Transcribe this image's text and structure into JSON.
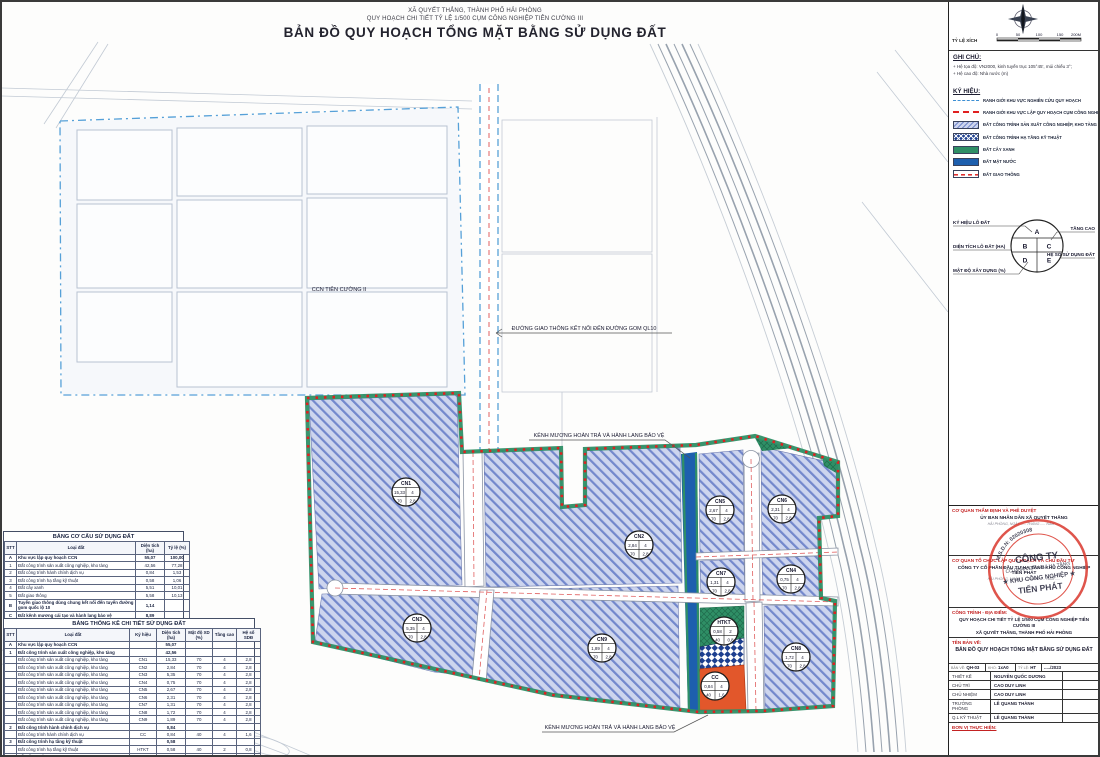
{
  "header": {
    "line1": "XÃ QUYẾT THẮNG, THÀNH PHỐ HẢI PHÒNG",
    "line2": "QUY HOẠCH CHI TIẾT TỶ LỆ 1/500 CỤM CÔNG NGHIỆP TIÊN CƯỜNG III",
    "title": "BẢN ĐỒ QUY HOẠCH TỔNG MẶT BẰNG SỬ DỤNG ĐẤT"
  },
  "scalebar": {
    "label": "TỶ LỆ XÍCH",
    "ticks": [
      "0",
      "50",
      "100",
      "150",
      "200M"
    ]
  },
  "notes": {
    "title": "GHI CHÚ:",
    "items": [
      "Hệ tọa độ: VN2000, kinh tuyến trục 105°45', múi chiếu 3°;",
      "Hệ cao độ: Nhà nước (m)"
    ]
  },
  "legend": {
    "title": "KÝ HIỆU:",
    "items": [
      {
        "key": "study",
        "label": "RANH GIỚI KHU VỰC NGHIÊN CỨU QUY HOẠCH"
      },
      {
        "key": "plan",
        "label": "RANH GIỚI KHU VỰC LẬP QUY HOẠCH CỤM CÔNG NGHIỆP"
      },
      {
        "key": "industrial",
        "label": "ĐẤT CÔNG TRÌNH SẢN XUẤT CÔNG NGHIỆP, KHO TÀNG"
      },
      {
        "key": "technical",
        "label": "ĐẤT CÔNG TRÌNH HẠ TẦNG KỸ THUẬT"
      },
      {
        "key": "green",
        "label": "ĐẤT CÂY XANH"
      },
      {
        "key": "water",
        "label": "ĐẤT MẶT NƯỚC"
      },
      {
        "key": "traffic",
        "label": "ĐẤT GIAO THÔNG"
      }
    ]
  },
  "parcel_key": {
    "key_label": "KÝ HIỆU LÔ ĐẤT",
    "area_label": "DIỆN TÍCH LÔ ĐẤT (HA)",
    "density_label": "MẬT ĐỘ XÂY DỰNG (%)",
    "floors_label": "TẦNG CAO",
    "far_label": "HỆ SỐ SỬ DỤNG ĐẤT",
    "cells": [
      "A",
      "B",
      "C",
      "D",
      "E"
    ]
  },
  "map": {
    "annotations": {
      "ccn2": "CCN TIÊN CƯỜNG II",
      "connect_road": "ĐƯỜNG GIAO THÔNG KẾT NỐI ĐẾN ĐƯỜNG GOM QL10",
      "channel_top": "KÊNH MƯƠNG HOÀN TRẢ VÀ HÀNH LANG BẢO VỆ",
      "channel_bottom": "KÊNH MƯƠNG HOÀN TRẢ VÀ HÀNH LANG BẢO VỆ"
    },
    "parcels": [
      {
        "id": "CN1",
        "area": "15,33",
        "floors": "4",
        "density": "70",
        "far": "2,8",
        "x": 404,
        "y": 490
      },
      {
        "id": "CN2",
        "area": "2,84",
        "floors": "4",
        "density": "70",
        "far": "2,8",
        "x": 637,
        "y": 543
      },
      {
        "id": "CN5",
        "area": "2,67",
        "floors": "4",
        "density": "70",
        "far": "2,8",
        "x": 718,
        "y": 508
      },
      {
        "id": "CN6",
        "area": "2,31",
        "floors": "4",
        "density": "70",
        "far": "2,8",
        "x": 780,
        "y": 507
      },
      {
        "id": "CN7",
        "area": "1,31",
        "floors": "4",
        "density": "70",
        "far": "2,8",
        "x": 719,
        "y": 580
      },
      {
        "id": "CN4",
        "area": "0,75",
        "floors": "4",
        "density": "70",
        "far": "2,8",
        "x": 789,
        "y": 577
      },
      {
        "id": "CN3",
        "area": "5,35",
        "floors": "4",
        "density": "70",
        "far": "2,8",
        "x": 415,
        "y": 626
      },
      {
        "id": "CN9",
        "area": "1,89",
        "floors": "4",
        "density": "70",
        "far": "2,8",
        "x": 600,
        "y": 646
      },
      {
        "id": "HTKT",
        "area": "0,58",
        "floors": "2",
        "density": "40",
        "far": "0,8",
        "x": 722,
        "y": 629
      },
      {
        "id": "CC",
        "area": "0,84",
        "floors": "4",
        "density": "40",
        "far": "1,6",
        "x": 713,
        "y": 684
      },
      {
        "id": "CN8",
        "area": "1,72",
        "floors": "4",
        "density": "70",
        "far": "2,8",
        "x": 794,
        "y": 655
      }
    ]
  },
  "tables": {
    "structure": {
      "title": "BẢNG CƠ CẤU SỬ DỤNG ĐẤT",
      "columns": [
        "STT",
        "Loại đất",
        "Diện tích (ha)",
        "Tỷ lệ (%)"
      ],
      "rows": [
        {
          "b": true,
          "c": [
            "A",
            "Khu vực lập quy hoạch CCN",
            "55,07",
            "100,00"
          ]
        },
        {
          "b": false,
          "c": [
            "1",
            "Đất công trình sản xuất công nghiệp, kho tàng",
            "42,56",
            "77,28"
          ]
        },
        {
          "b": false,
          "c": [
            "2",
            "Đất công trình hành chính dịch vụ",
            "0,84",
            "1,53"
          ]
        },
        {
          "b": false,
          "c": [
            "3",
            "Đất công trình hạ tầng kỹ thuật",
            "0,58",
            "1,06"
          ]
        },
        {
          "b": false,
          "c": [
            "4",
            "Đất cây xanh",
            "5,51",
            "10,01"
          ]
        },
        {
          "b": false,
          "c": [
            "5",
            "Đất giao thông",
            "5,58",
            "10,13"
          ]
        },
        {
          "b": true,
          "c": [
            "B",
            "Tuyến giao thông dùng chung kết nối đến tuyến đường gom quốc lộ 10",
            "1,14",
            ""
          ]
        },
        {
          "b": true,
          "c": [
            "C",
            "Đất kênh mương cải tạo và hành lang bảo vệ",
            "8,89",
            ""
          ]
        }
      ]
    },
    "detail": {
      "title": "BẢNG THỐNG KÊ CHI TIẾT SỬ DỤNG ĐẤT",
      "columns": [
        "STT",
        "Loại đất",
        "Ký hiệu",
        "Diện tích (ha)",
        "Mật độ XD (%)",
        "Tầng cao",
        "Hệ số SDĐ"
      ],
      "rows": [
        {
          "b": true,
          "c": [
            "A",
            "Khu vực lập quy hoạch CCN",
            "",
            "55,07",
            "",
            "",
            ""
          ]
        },
        {
          "b": true,
          "c": [
            "1",
            "Đất công trình sản xuất công nghiệp, kho tàng",
            "",
            "42,56",
            "",
            "",
            ""
          ]
        },
        {
          "b": false,
          "c": [
            "",
            "Đất công trình sản xuất công nghiệp, kho tàng",
            "CN1",
            "15,33",
            "70",
            "4",
            "2,8"
          ]
        },
        {
          "b": false,
          "c": [
            "",
            "Đất công trình sản xuất công nghiệp, kho tàng",
            "CN2",
            "2,84",
            "70",
            "4",
            "2,8"
          ]
        },
        {
          "b": false,
          "c": [
            "",
            "Đất công trình sản xuất công nghiệp, kho tàng",
            "CN3",
            "5,35",
            "70",
            "4",
            "2,8"
          ]
        },
        {
          "b": false,
          "c": [
            "",
            "Đất công trình sản xuất công nghiệp, kho tàng",
            "CN4",
            "0,75",
            "70",
            "4",
            "2,8"
          ]
        },
        {
          "b": false,
          "c": [
            "",
            "Đất công trình sản xuất công nghiệp, kho tàng",
            "CN5",
            "2,67",
            "70",
            "4",
            "2,8"
          ]
        },
        {
          "b": false,
          "c": [
            "",
            "Đất công trình sản xuất công nghiệp, kho tàng",
            "CN6",
            "2,31",
            "70",
            "4",
            "2,8"
          ]
        },
        {
          "b": false,
          "c": [
            "",
            "Đất công trình sản xuất công nghiệp, kho tàng",
            "CN7",
            "1,31",
            "70",
            "4",
            "2,8"
          ]
        },
        {
          "b": false,
          "c": [
            "",
            "Đất công trình sản xuất công nghiệp, kho tàng",
            "CN8",
            "1,72",
            "70",
            "4",
            "2,8"
          ]
        },
        {
          "b": false,
          "c": [
            "",
            "Đất công trình sản xuất công nghiệp, kho tàng",
            "CN9",
            "1,89",
            "70",
            "4",
            "2,8"
          ]
        },
        {
          "b": true,
          "c": [
            "2",
            "Đất công trình hành chính dịch vụ",
            "",
            "0,84",
            "",
            "",
            ""
          ]
        },
        {
          "b": false,
          "c": [
            "",
            "Đất công trình hành chính dịch vụ",
            "CC",
            "0,84",
            "40",
            "4",
            "1,6"
          ]
        },
        {
          "b": true,
          "c": [
            "3",
            "Đất công trình hạ tầng kỹ thuật",
            "",
            "0,58",
            "",
            "",
            ""
          ]
        },
        {
          "b": false,
          "c": [
            "",
            "Đất công trình hạ tầng kỹ thuật",
            "HTKT",
            "0,58",
            "40",
            "2",
            "0,8"
          ]
        },
        {
          "b": true,
          "c": [
            "4",
            "Đất cây xanh",
            "",
            "5,51",
            "",
            "",
            ""
          ]
        },
        {
          "b": false,
          "c": [
            "",
            "Đất cây xanh",
            "CX",
            "5,51",
            "5",
            "2",
            "0,1"
          ]
        },
        {
          "b": true,
          "c": [
            "5",
            "Đất giao thông",
            "",
            "5,58",
            "",
            "",
            ""
          ]
        },
        {
          "b": false,
          "c": [
            "",
            "Đất giao thông",
            "",
            "5,58",
            "-",
            "-",
            "-"
          ]
        }
      ]
    }
  },
  "titleblock": {
    "approve": {
      "label": "CƠ QUAN THẨM ĐỊNH VÀ PHÊ DUYỆT",
      "name": "ỦY BAN NHÂN DÂN XÃ QUYẾT THẮNG"
    },
    "org": {
      "label": "CƠ QUAN TỔ CHỨC LẬP QUY HOẠCH VÀ CHỦ ĐẦU TƯ",
      "name": "CÔNG TY CỔ PHẦN ĐẦU TƯ HẠ TẦNG KHU CÔNG NGHIỆP TIẾN PHÁT"
    },
    "date_line": "HẢI PHÒNG, NGÀY ..... THÁNG ..... NĂM .....",
    "project": {
      "label": "CÔNG TRÌNH - ĐỊA ĐIỂM:",
      "line1": "QUY HOẠCH CHI TIẾT TỶ LỆ 1/500 CỤM CÔNG NGHIỆP TIÊN CƯỜNG III",
      "line2": "XÃ QUYẾT THẮNG, THÀNH PHỐ HẢI PHÒNG"
    },
    "drawing": {
      "label": "TÊN BẢN VẼ:",
      "name": "BẢN ĐỒ QUY HOẠCH TỔNG MẶT BẰNG SỬ DỤNG ĐẤT"
    },
    "meta": [
      {
        "l": "BẢN VẼ:",
        "v": "QH-03"
      },
      {
        "l": "KHỔ:",
        "v": "1xA0"
      },
      {
        "l": "TỶ LỆ:",
        "v": "HT"
      },
      {
        "l": "",
        "v": "...../2023"
      }
    ],
    "personnel": [
      {
        "role": "THIẾT KẾ",
        "name": "NGUYỄN QUỐC DƯƠNG"
      },
      {
        "role": "CHỦ TRÌ",
        "name": "CAO DUY LINH"
      },
      {
        "role": "CHỦ NHIỆM",
        "name": "CAO DUY LINH"
      },
      {
        "role": "TRƯỞNG PHÒNG",
        "name": "LÊ QUANG THÀNH"
      },
      {
        "role": "Q.L KỸ THUẬT",
        "name": "LÊ QUANG THÀNH"
      }
    ],
    "executor": {
      "label": "ĐƠN VỊ THỰC HIỆN:",
      "logo": "CMB",
      "company": "CÔNG TY CỔ PHẦN TƯ VẤN XÂY DỰNG CÔNG TRÌNH HÀNG HẢI",
      "company_en": "CONSTRUCTION CONSULTATION JSC FOR MARITIME BUILDING"
    },
    "stamp": {
      "ring": "M.S.D.N: 02020308",
      "line1": "CÔNG TY",
      "line2": "CỔ PHẦN ĐẦU TƯ HẠ TẦNG",
      "line3": "★ KHU CÔNG NGHIỆP ★",
      "line4": "TIẾN PHÁT"
    }
  },
  "colors": {
    "industrial_bg": "#cdd5ee",
    "industrial_line": "#7388cc",
    "green": "#2f8f66",
    "water": "#1d5fae",
    "service_orange": "#e2572b",
    "technical_blue": "#1d3f8f",
    "boundary_red": "#e02020",
    "study_blue": "#3d8fd4"
  }
}
